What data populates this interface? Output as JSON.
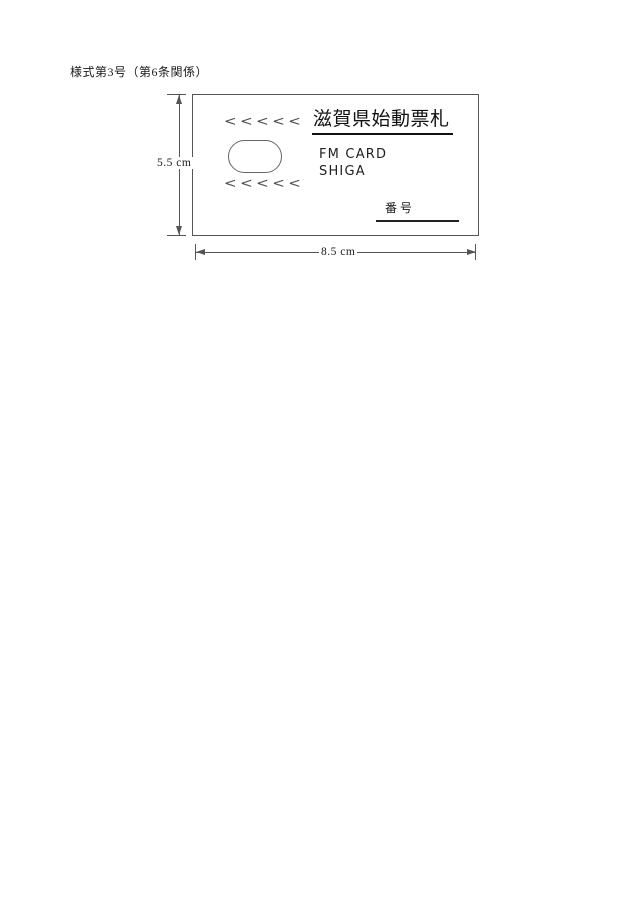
{
  "document": {
    "form_label": "様式第3号（第6条関係）"
  },
  "card": {
    "title": "滋賀県始動票札",
    "chevrons_top": "<<<<<",
    "chevrons_bottom": "<<<<<",
    "line1": "FM CARD",
    "line2": "SHIGA",
    "number_label": "番号"
  },
  "dimensions": {
    "height": "5.5 cm",
    "width": "8.5 cm"
  },
  "colors": {
    "line": "#555555",
    "text": "#1a1a1a",
    "background": "#ffffff"
  }
}
